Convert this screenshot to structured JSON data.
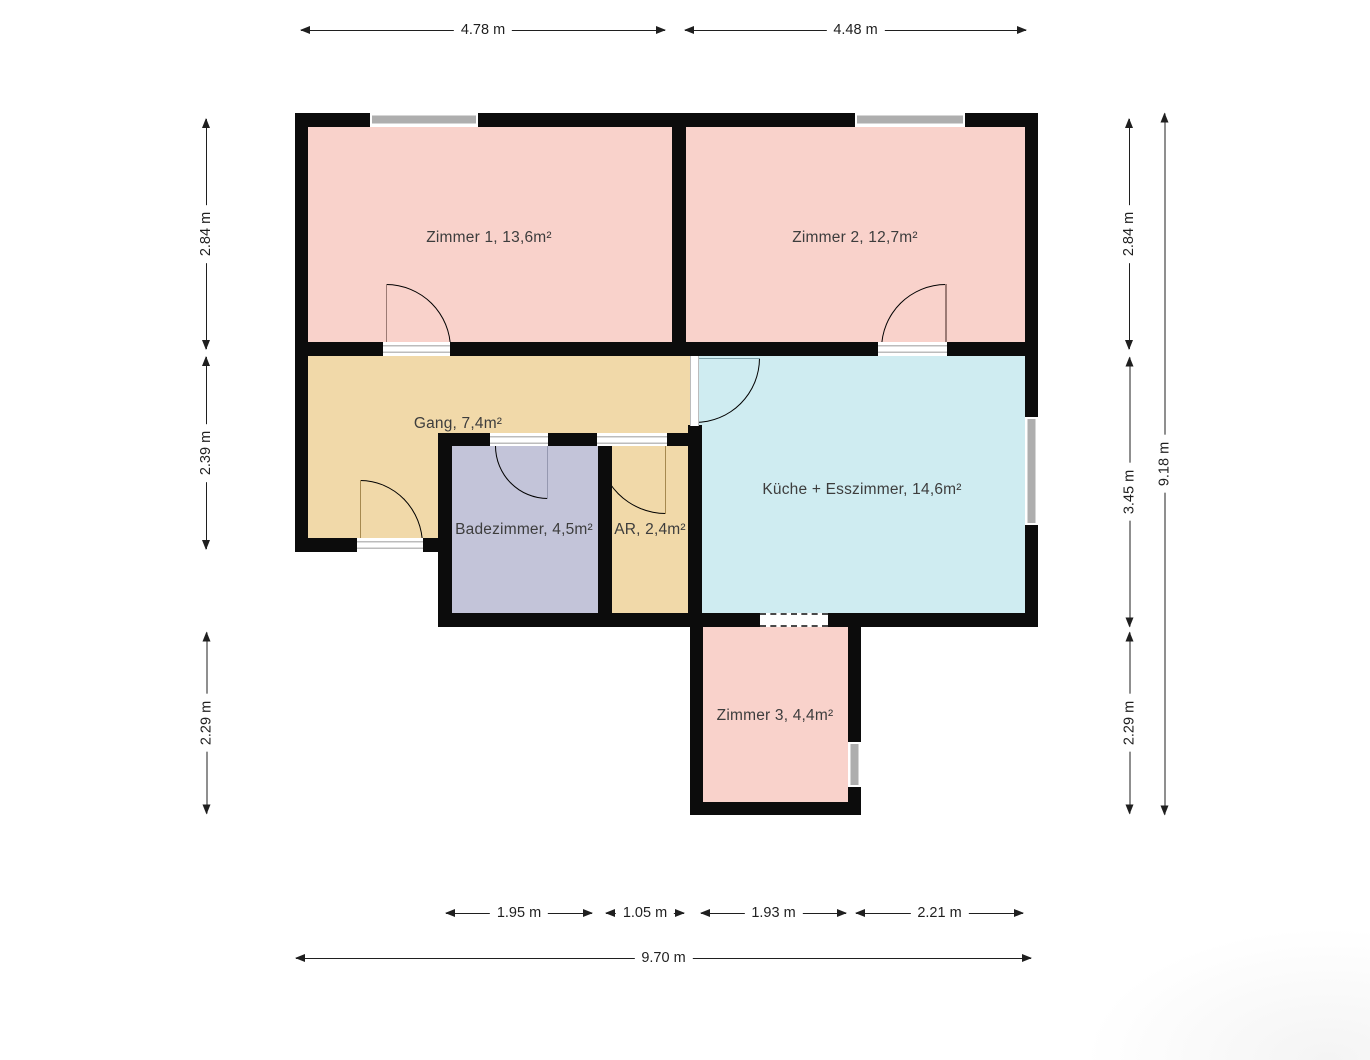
{
  "plan": {
    "type": "floorplan",
    "rooms": [
      {
        "id": "zimmer1",
        "label": "Zimmer 1, 13,6m²"
      },
      {
        "id": "zimmer2",
        "label": "Zimmer 2, 12,7m²"
      },
      {
        "id": "gang",
        "label": "Gang, 7,4m²"
      },
      {
        "id": "kueche",
        "label": "Küche + Esszimmer, 14,6m²"
      },
      {
        "id": "badezimmer",
        "label": "Badezimmer, 4,5m²"
      },
      {
        "id": "ar",
        "label": "AR, 2,4m²"
      },
      {
        "id": "zimmer3",
        "label": "Zimmer 3, 4,4m²"
      }
    ],
    "dimensions": {
      "top": [
        "4.78 m",
        "4.48 m"
      ],
      "left": [
        "2.84 m",
        "2.39 m",
        "2.29 m"
      ],
      "right_inner": [
        "2.84 m",
        "3.45 m",
        "2.29 m"
      ],
      "right_total": "9.18 m",
      "bottom": [
        "1.95 m",
        "1.05 m",
        "1.93 m",
        "2.21 m"
      ],
      "bottom_total": "9.70 m"
    },
    "colors": {
      "wall": "#0c0c0c",
      "room_pink": "#f9d2cb",
      "room_tan": "#f1d9a9",
      "room_lavender": "#c3c4d9",
      "room_blue": "#cfecf1",
      "window_glass": "#aeaeae",
      "dimension_line": "#1f1f1f",
      "label_text": "#3d3d3d"
    }
  }
}
